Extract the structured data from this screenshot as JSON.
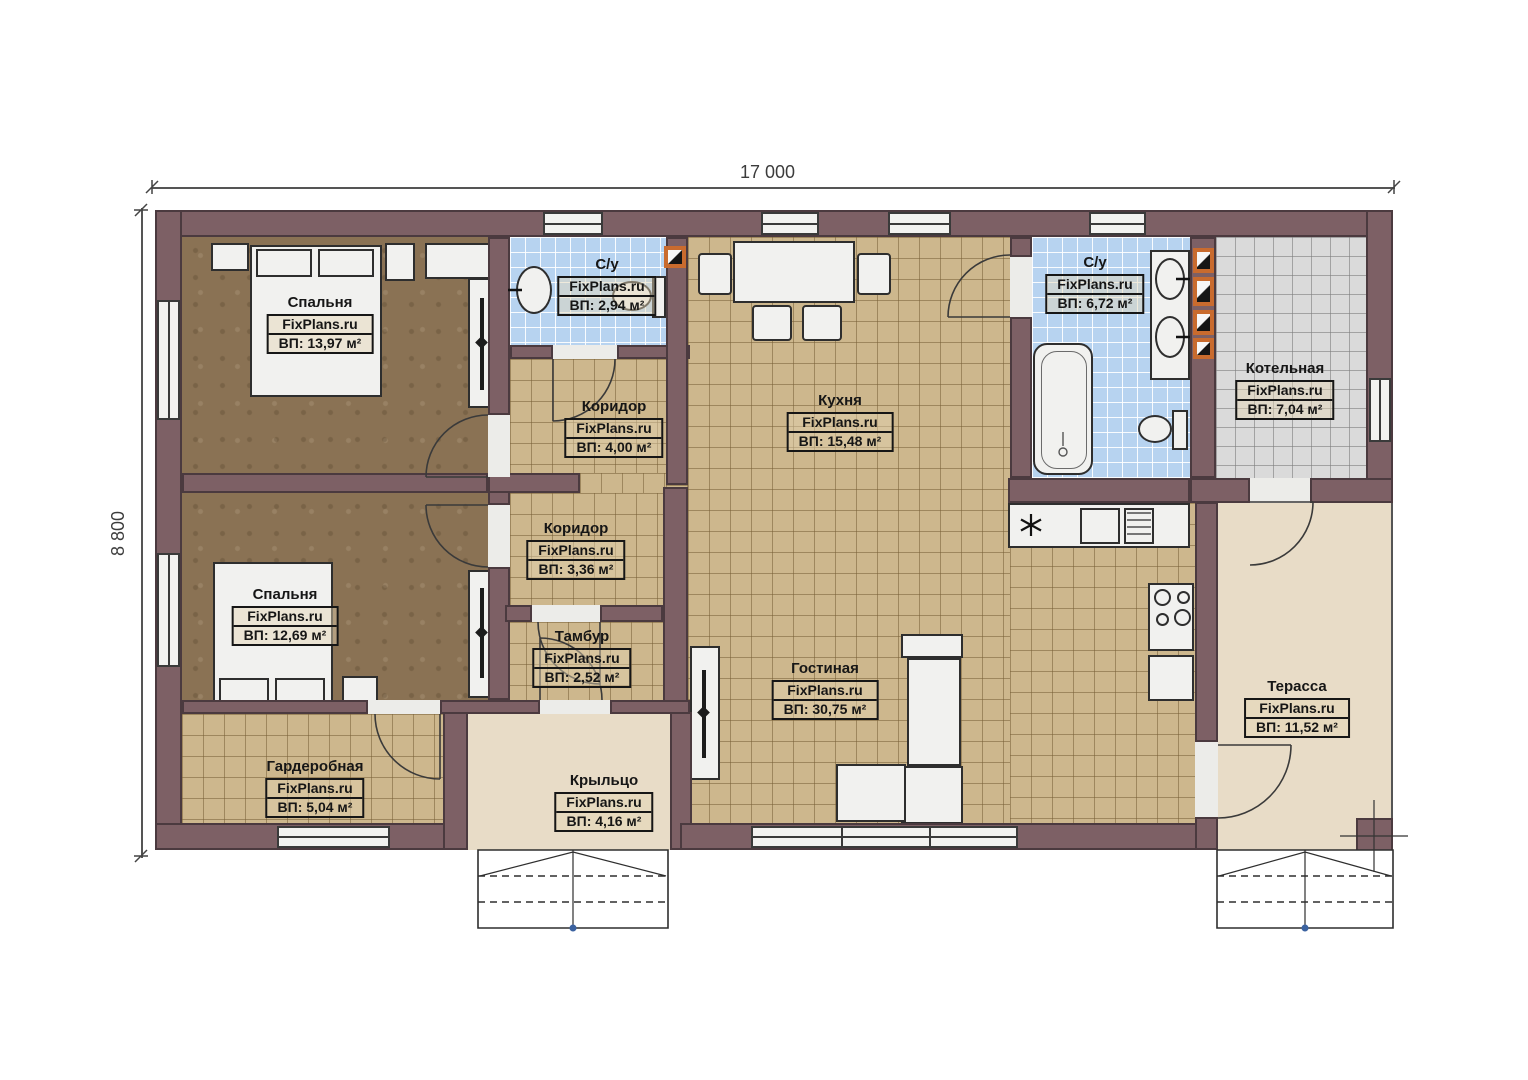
{
  "plan": {
    "type": "single-storey house floor plan",
    "dimensions": {
      "width_label": "17 000",
      "height_label": "8 800"
    },
    "watermark": "FixPlans.ru"
  },
  "rooms": {
    "bedroom1": {
      "name": "Спальня",
      "brand": "FixPlans.ru",
      "area": "ВП: 13,97 м²"
    },
    "bedroom2": {
      "name": "Спальня",
      "brand": "FixPlans.ru",
      "area": "ВП: 12,69 м²"
    },
    "wardrobe": {
      "name": "Гардеробная",
      "brand": "FixPlans.ru",
      "area": "ВП: 5,04 м²"
    },
    "bathroom1": {
      "name": "С/у",
      "brand": "FixPlans.ru",
      "area": "ВП: 2,94 м²"
    },
    "corridor1": {
      "name": "Коридор",
      "brand": "FixPlans.ru",
      "area": "ВП: 4,00 м²"
    },
    "corridor2": {
      "name": "Коридор",
      "brand": "FixPlans.ru",
      "area": "ВП: 3,36 м²"
    },
    "vestibule": {
      "name": "Тамбур",
      "brand": "FixPlans.ru",
      "area": "ВП: 2,52 м²"
    },
    "porch": {
      "name": "Крыльцо",
      "brand": "FixPlans.ru",
      "area": "ВП: 4,16 м²"
    },
    "kitchen": {
      "name": "Кухня",
      "brand": "FixPlans.ru",
      "area": "ВП: 15,48 м²"
    },
    "living": {
      "name": "Гостиная",
      "brand": "FixPlans.ru",
      "area": "ВП: 30,75 м²"
    },
    "bathroom2": {
      "name": "С/у",
      "brand": "FixPlans.ru",
      "area": "ВП: 6,72 м²"
    },
    "boiler": {
      "name": "Котельная",
      "brand": "FixPlans.ru",
      "area": "ВП: 7,04 м²"
    },
    "terrace": {
      "name": "Терасса",
      "brand": "FixPlans.ru",
      "area": "ВП: 11,52 м²"
    }
  },
  "palette": {
    "wall": "#7d6065",
    "wood_floor": "#8a7254",
    "tile_beige": "#cdb78d",
    "tile_blue": "#b7d3f0",
    "tile_gray": "#dadada",
    "outdoor_floor": "#e8dcc7",
    "fixture_white": "#f1f1ef",
    "vent_orange": "#c96b2e"
  },
  "icons": {
    "sink_star": "✳",
    "stair_direction": "▲",
    "section_marker": "◆"
  }
}
